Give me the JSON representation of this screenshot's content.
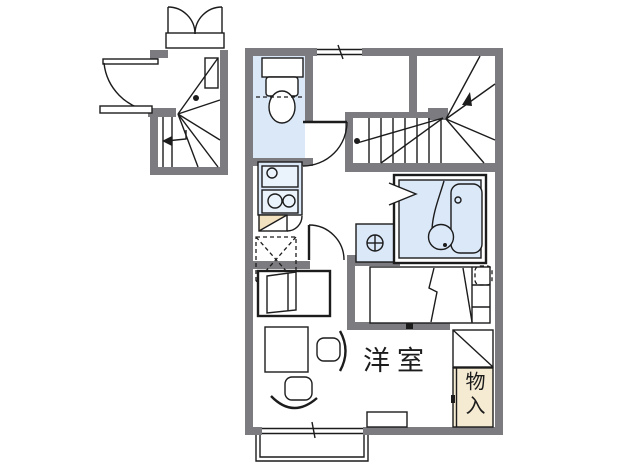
{
  "floorplan": {
    "rooms": {
      "western_room_label": "洋室",
      "storage_label": "物入"
    },
    "colors": {
      "wall": "#7b7b80",
      "water": "#dbe8f8",
      "water_light": "#eaf2fc",
      "closet": "#f5ead2",
      "counter": "#f3e2c0",
      "line": "#1c1c1c",
      "background": "#ffffff"
    },
    "fixtures": [
      "entrance-double-door",
      "entrance-swing-door",
      "winder-staircase-1f",
      "staircase-2f",
      "direction-arrows",
      "toilet",
      "toilet-door",
      "hall-window",
      "kitchen-sink",
      "gas-stove",
      "kitchen-counter",
      "refrigerator-space",
      "interior-door",
      "washing-machine-space",
      "unit-bath",
      "bathtub",
      "washbasin",
      "bathroom-folding-door",
      "bed",
      "table",
      "chairs",
      "tv-stand",
      "storage-closet",
      "shelf",
      "balcony",
      "sliding-window",
      "counter-ledge"
    ]
  }
}
